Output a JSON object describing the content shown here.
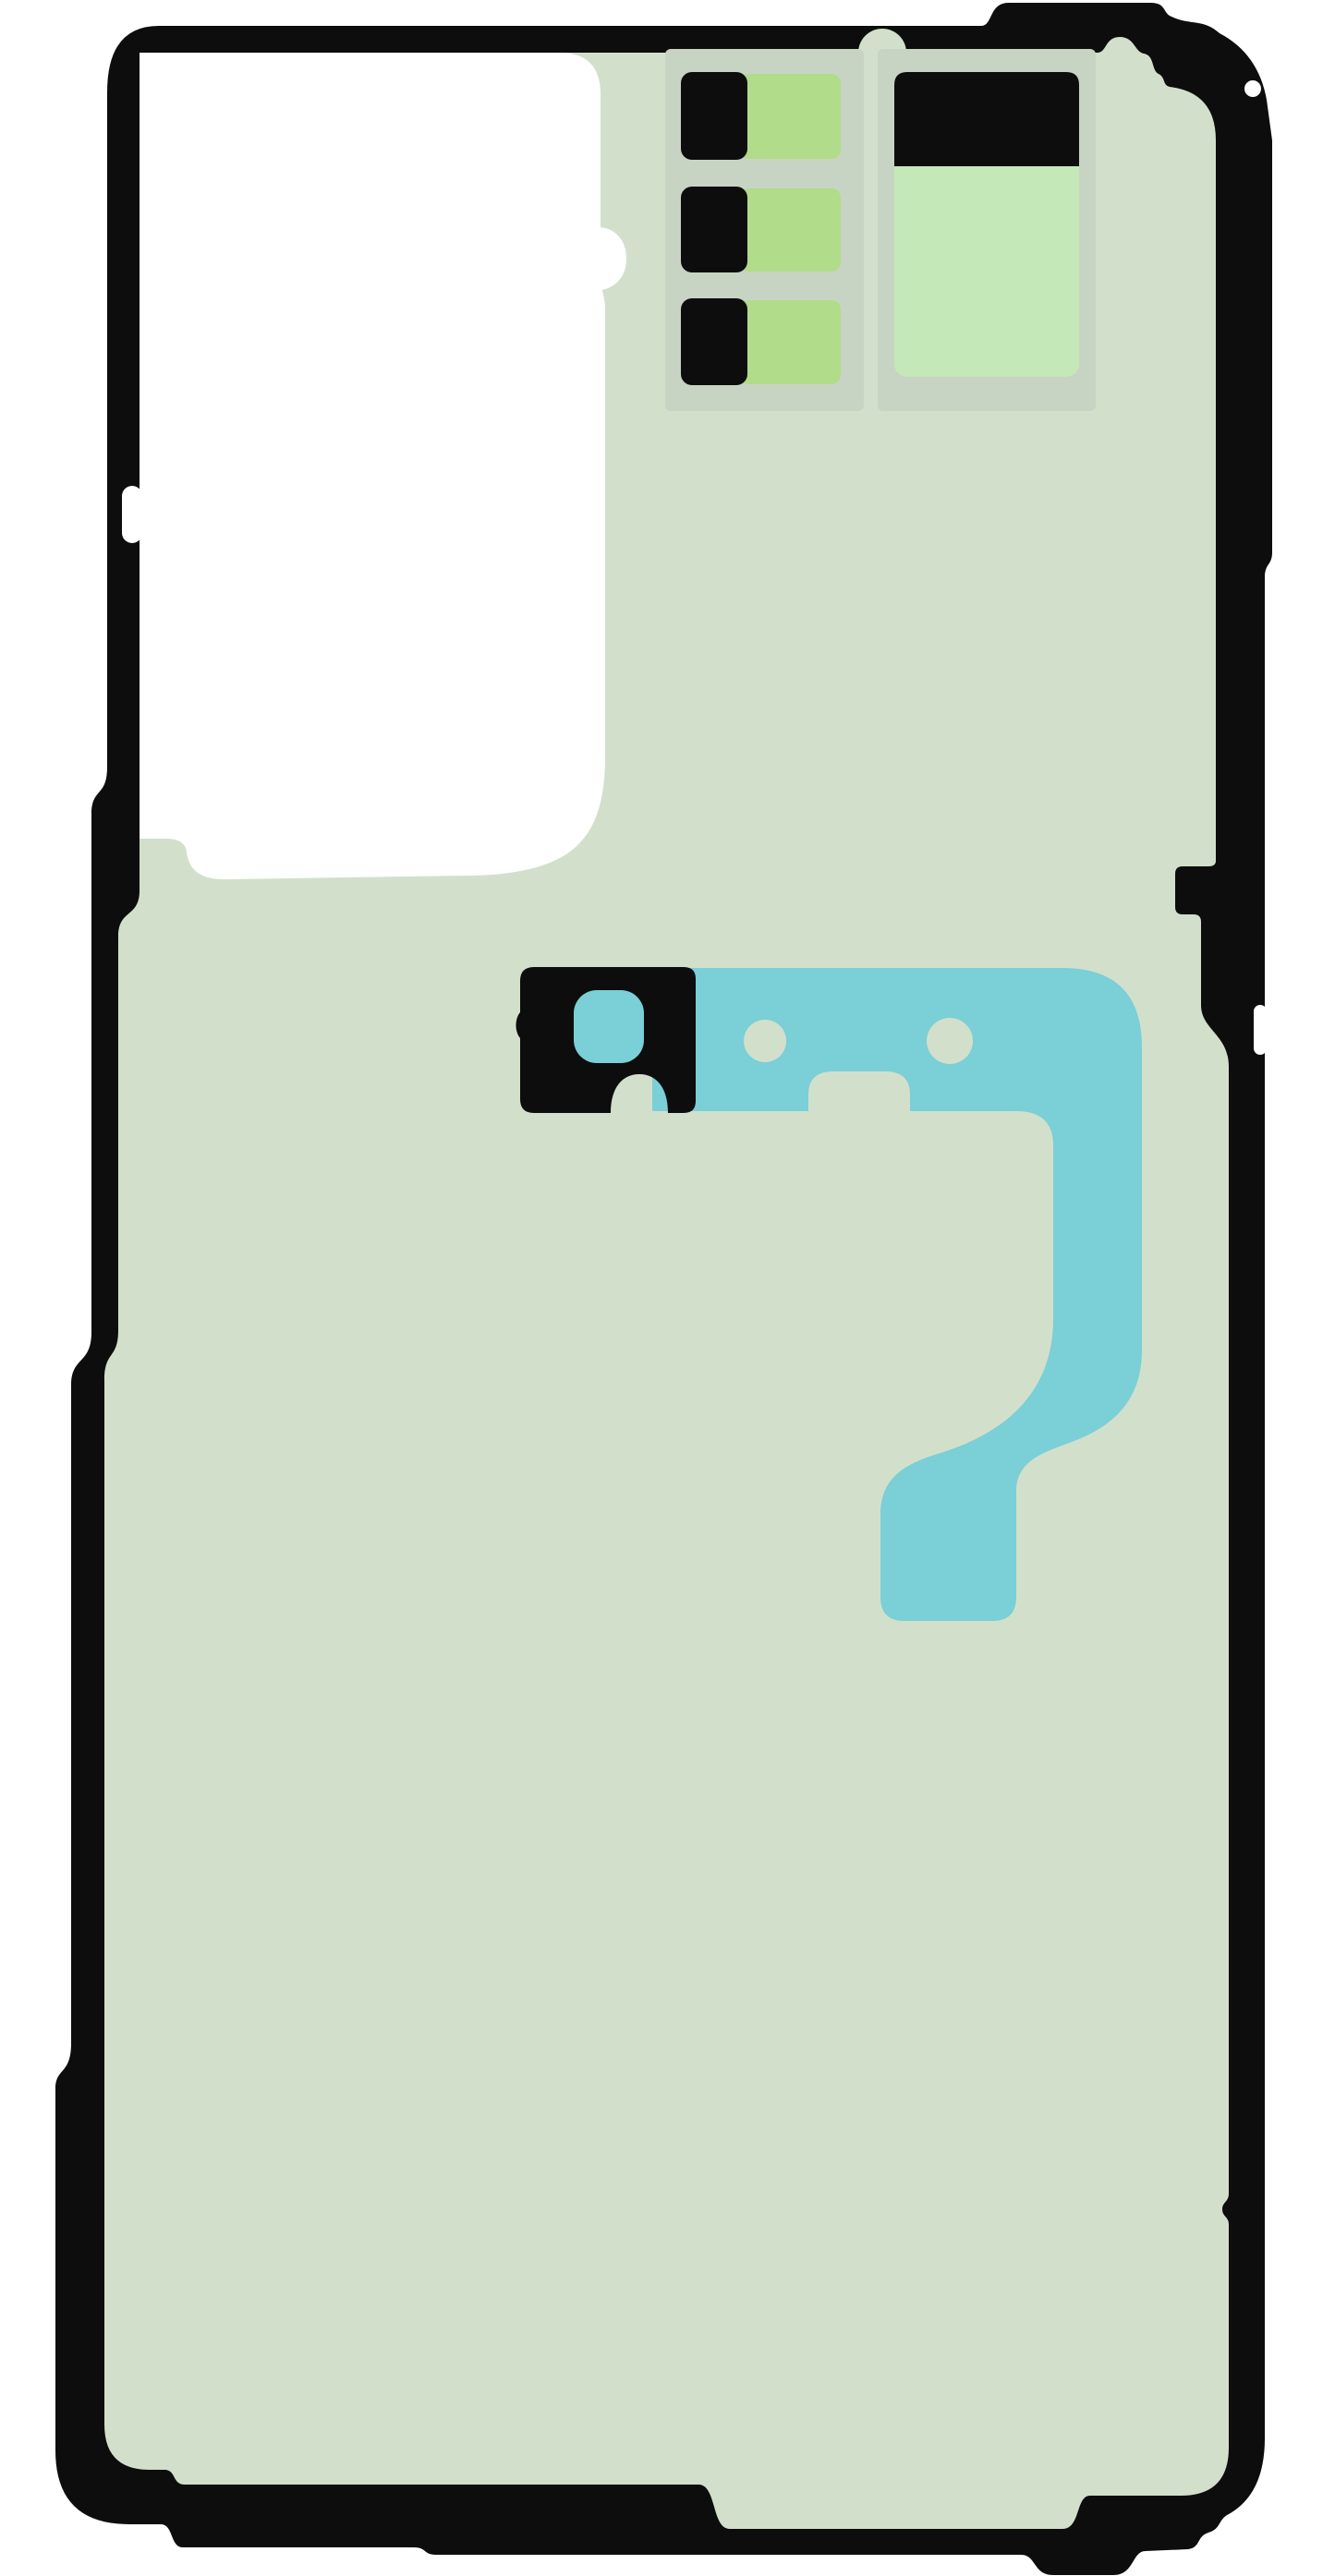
{
  "illustration": {
    "kind": "rear-cover-adhesive-sheet",
    "has_text": false,
    "left_card_rows": 3,
    "flex_adhesive_holes": 2
  },
  "colors": {
    "page": "#ffffff",
    "outline": "#0d0d0d",
    "liner": "#d2e0cb",
    "card": "#c8d4c3",
    "swatch_black": "#0d0d0d",
    "swatch_green": "#b1dc8a",
    "mint": "#c5e8b8",
    "cyan": "#7bcfd6",
    "white": "#ffffff"
  }
}
